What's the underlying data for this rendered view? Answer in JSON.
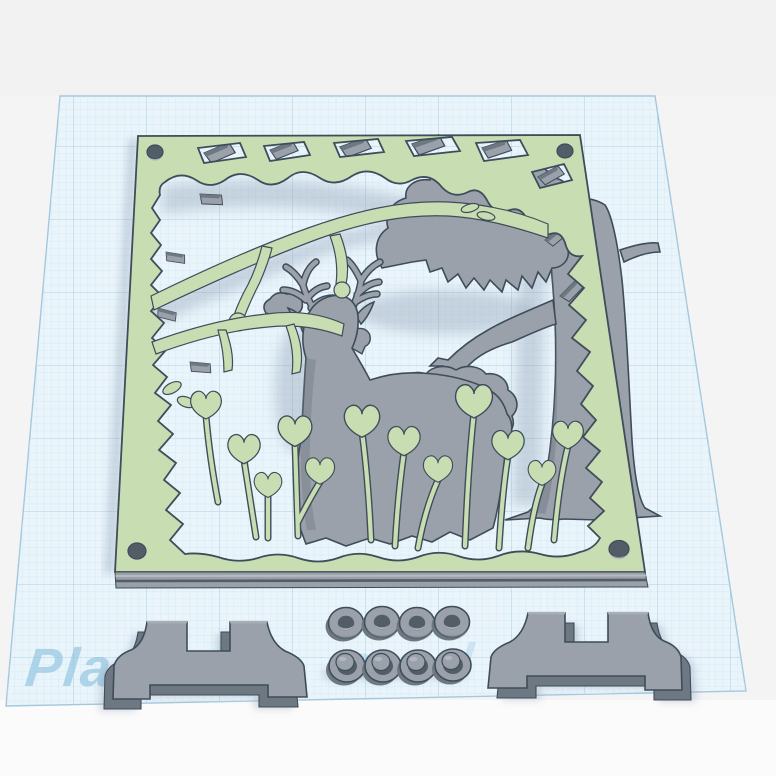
{
  "workplane": {
    "watermark_fragments": [
      "Plan",
      "o",
      "d"
    ],
    "description": "perspective grid build plate"
  },
  "scene": {
    "objects": [
      {
        "id": "plaque",
        "label": "deer forest scene front panel",
        "color_key": "green"
      },
      {
        "id": "deer",
        "label": "deer silhouette insert",
        "color_key": "gray"
      },
      {
        "id": "tree",
        "label": "tree trunk insert",
        "color_key": "gray"
      },
      {
        "id": "foliage",
        "label": "bush / canopy inserts",
        "color_key": "gray"
      },
      {
        "id": "feet",
        "label": "stand feet",
        "count": 2
      },
      {
        "id": "washers",
        "label": "spacer washers",
        "count": 8
      },
      {
        "id": "screw_holes",
        "label": "corner screw holes",
        "count": 4
      }
    ]
  },
  "palette": {
    "bg": "#f4f4f5",
    "bg_top": "#f2f2f3",
    "bg_bottom": "#fbfbfb",
    "plane_fill": "#eaf4fb",
    "grid_minor": "#cfe6f2",
    "grid_major": "#abd2e4",
    "plane_edge": "#a3c8db",
    "watermark": "#8fc3e0",
    "green": "#c9ddb3",
    "outline": "#3e4d5a",
    "gray": "#9ba1ab",
    "gray_dark": "#6e7883",
    "gray_deep": "#535d67",
    "gray_light": "#b6bbc2",
    "shadow": "#8096ab",
    "band": "#99a0a8"
  }
}
